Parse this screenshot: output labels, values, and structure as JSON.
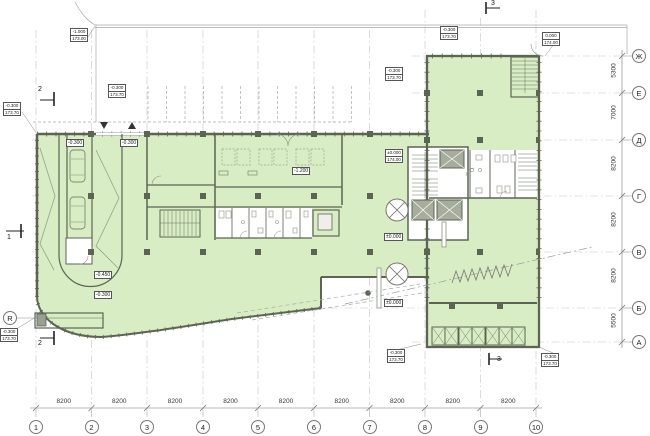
{
  "colors": {
    "plan_fill": "#d9edc5",
    "wall": "#5c6454"
  },
  "axes": {
    "bottom": [
      "1",
      "2",
      "3",
      "4",
      "5",
      "6",
      "7",
      "8",
      "9",
      "10"
    ],
    "right": [
      "Ж",
      "Е",
      "Д",
      "Г",
      "В",
      "Б",
      "А"
    ],
    "left": "R"
  },
  "dimensions": {
    "bottom": [
      "8200",
      "8200",
      "8200",
      "8200",
      "8200",
      "8200",
      "8200",
      "8200",
      "8200"
    ],
    "right": [
      "5300",
      "7000",
      "8200",
      "8200",
      "8200",
      "5500"
    ]
  },
  "sections": {
    "one": "1",
    "two": "2",
    "three": "3"
  },
  "levels": {
    "ramp_top_left": "-0.300",
    "ramp_top_right": "-0.300",
    "ramp_mid": "-0.450",
    "ramp_low": "-0.300",
    "mid_room": "-1.200",
    "zero_main": "±0.000",
    "zero_south": "±0.000",
    "m1": {
      "top": "-1.000",
      "bottom": "173.00"
    },
    "m2": {
      "top": "-0.300",
      "bottom": "173.70"
    },
    "m3": {
      "top": "-0.300",
      "bottom": "173.70"
    },
    "m4": {
      "top": "-0.300",
      "bottom": "173.70"
    },
    "m5": {
      "top": "-0.300",
      "bottom": "173.70"
    },
    "m6": {
      "top": "0.000",
      "bottom": "174.00"
    },
    "m7": {
      "top": "±0.000",
      "bottom": "174.00"
    },
    "m8": {
      "top": "-0.300",
      "bottom": "173.70"
    },
    "m9": {
      "top": "-0.300",
      "bottom": "173.70"
    },
    "m10": {
      "top": "-0.300",
      "bottom": "173.70"
    }
  }
}
